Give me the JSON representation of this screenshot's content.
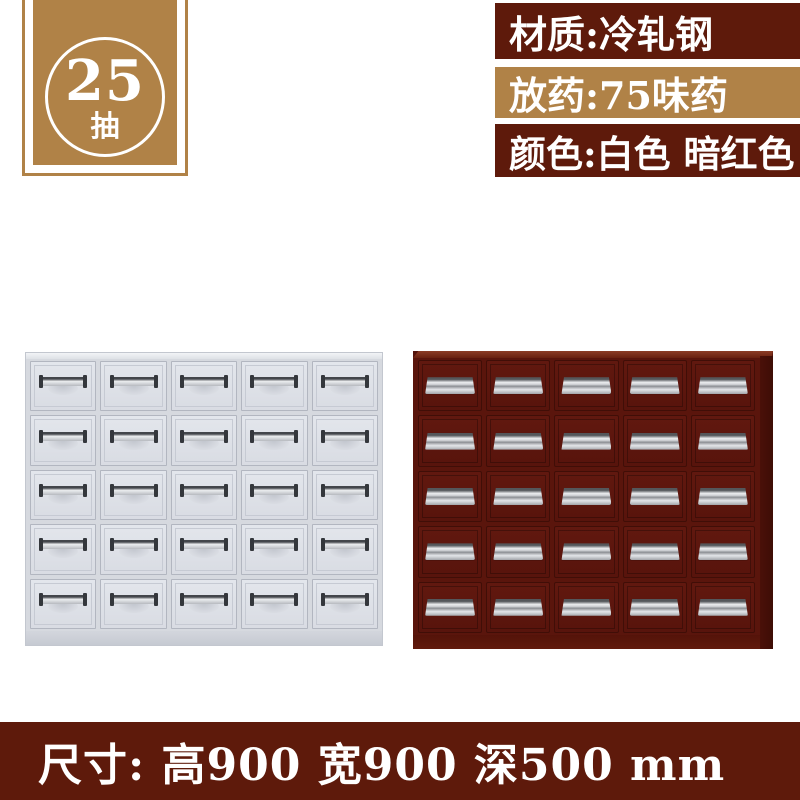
{
  "badge": {
    "number": "25",
    "unit": "抽"
  },
  "spec_labels": [
    {
      "text": "材质:冷轧钢",
      "bg": "#5e1a0b"
    },
    {
      "text": "放药:75味药",
      "bg": "#b08247"
    },
    {
      "text": "颜色:白色 暗红色",
      "bg": "#5e1a0b"
    }
  ],
  "cabinets": [
    {
      "name": "white-cabinet",
      "color_label": "白色",
      "rows": 5,
      "cols": 5,
      "drawer_count": 25,
      "handle_style": "bar"
    },
    {
      "name": "dark-red-cabinet",
      "color_label": "暗红色",
      "rows": 5,
      "cols": 5,
      "drawer_count": 25,
      "handle_style": "tray"
    }
  ],
  "footer": {
    "text": "尺寸: 高900 宽900 深500 mm"
  },
  "colors": {
    "maroon": "#5e1a0b",
    "tan": "#b08247",
    "white_cabinet_body": "#d6d9df",
    "white_drawer_front": "#dee1e7",
    "red_cabinet_body": "#5a150c",
    "red_cabinet_side": "#420e07",
    "handle_silver": "#d0d2d6",
    "text": "#ffffff",
    "background": "#ffffff"
  }
}
